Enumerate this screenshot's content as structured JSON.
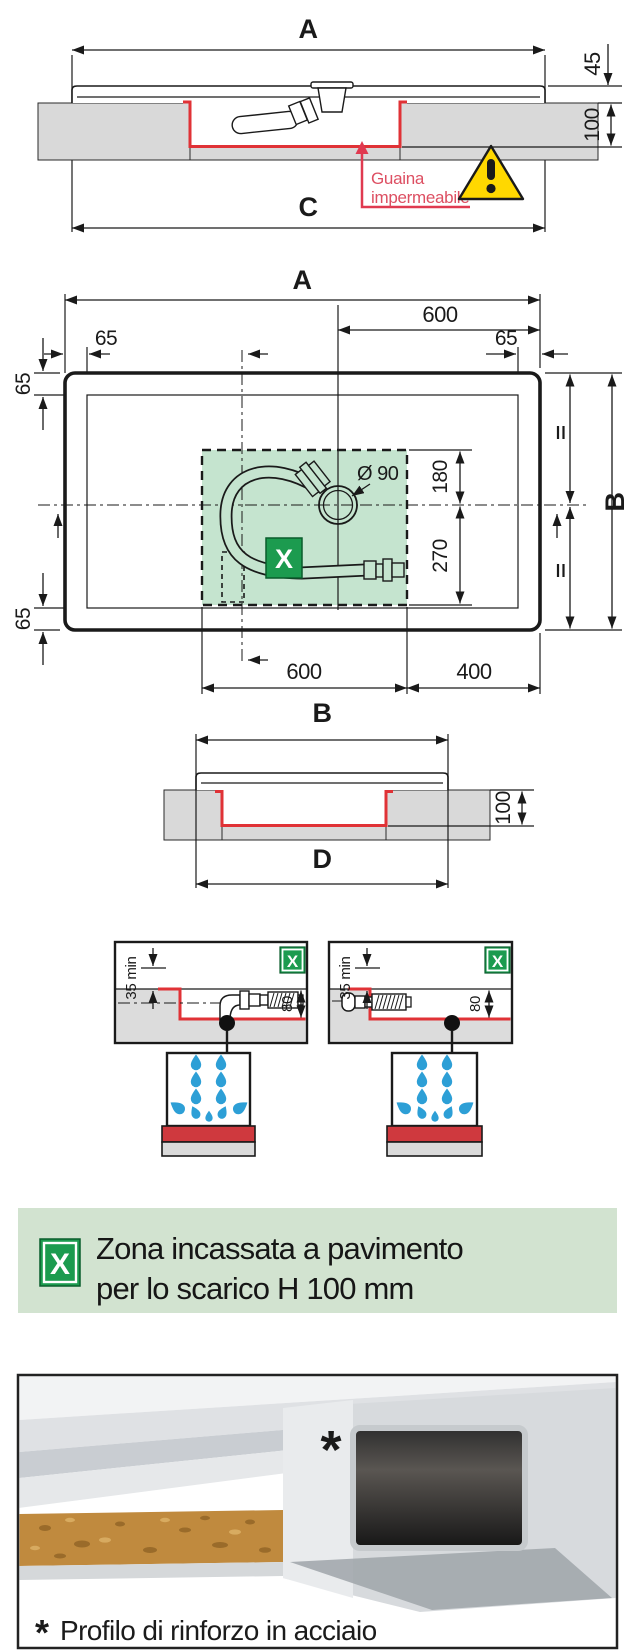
{
  "colors": {
    "red_line": "#e03236",
    "red_text": "#dd4f62",
    "badge_green": "#1c9b4f",
    "zone_green": "#c5e4cf",
    "banner_bg": "#d2e3d0",
    "drop_blue": "#2d9fd6",
    "warning_yellow": "#ffd800",
    "slab_gray": "#d9d9d9"
  },
  "section_top": {
    "dim_a": "A",
    "dim_45": "45",
    "dim_100": "100",
    "dim_c": "C",
    "note_line1": "Guaina",
    "note_line2": "impermeabile"
  },
  "plan": {
    "dim_a": "A",
    "dim_600_top": "600",
    "dim_65_top_left": "65",
    "dim_65_top_right": "65",
    "dim_65_left_top": "65",
    "dim_65_left_bottom": "65",
    "drain_label": "Ø 90",
    "dim_180": "180",
    "dim_270": "270",
    "dim_b": "B",
    "dim_600_bottom": "600",
    "dim_400": "400",
    "x_label": "X"
  },
  "section_mid": {
    "dim_b": "B",
    "dim_100": "100",
    "dim_d": "D"
  },
  "detail_left": {
    "x_label": "X",
    "dim_35": "35 min",
    "dim_80": "80"
  },
  "detail_right": {
    "x_label": "X",
    "dim_35": "35 min",
    "dim_80": "80"
  },
  "legend": {
    "x_label": "X",
    "line1": "Zona incassata a pavimento",
    "line2": "per lo scarico H 100 mm"
  },
  "photo": {
    "marker": "*",
    "caption_marker": "*",
    "caption": "Profilo di rinforzo in acciaio"
  }
}
